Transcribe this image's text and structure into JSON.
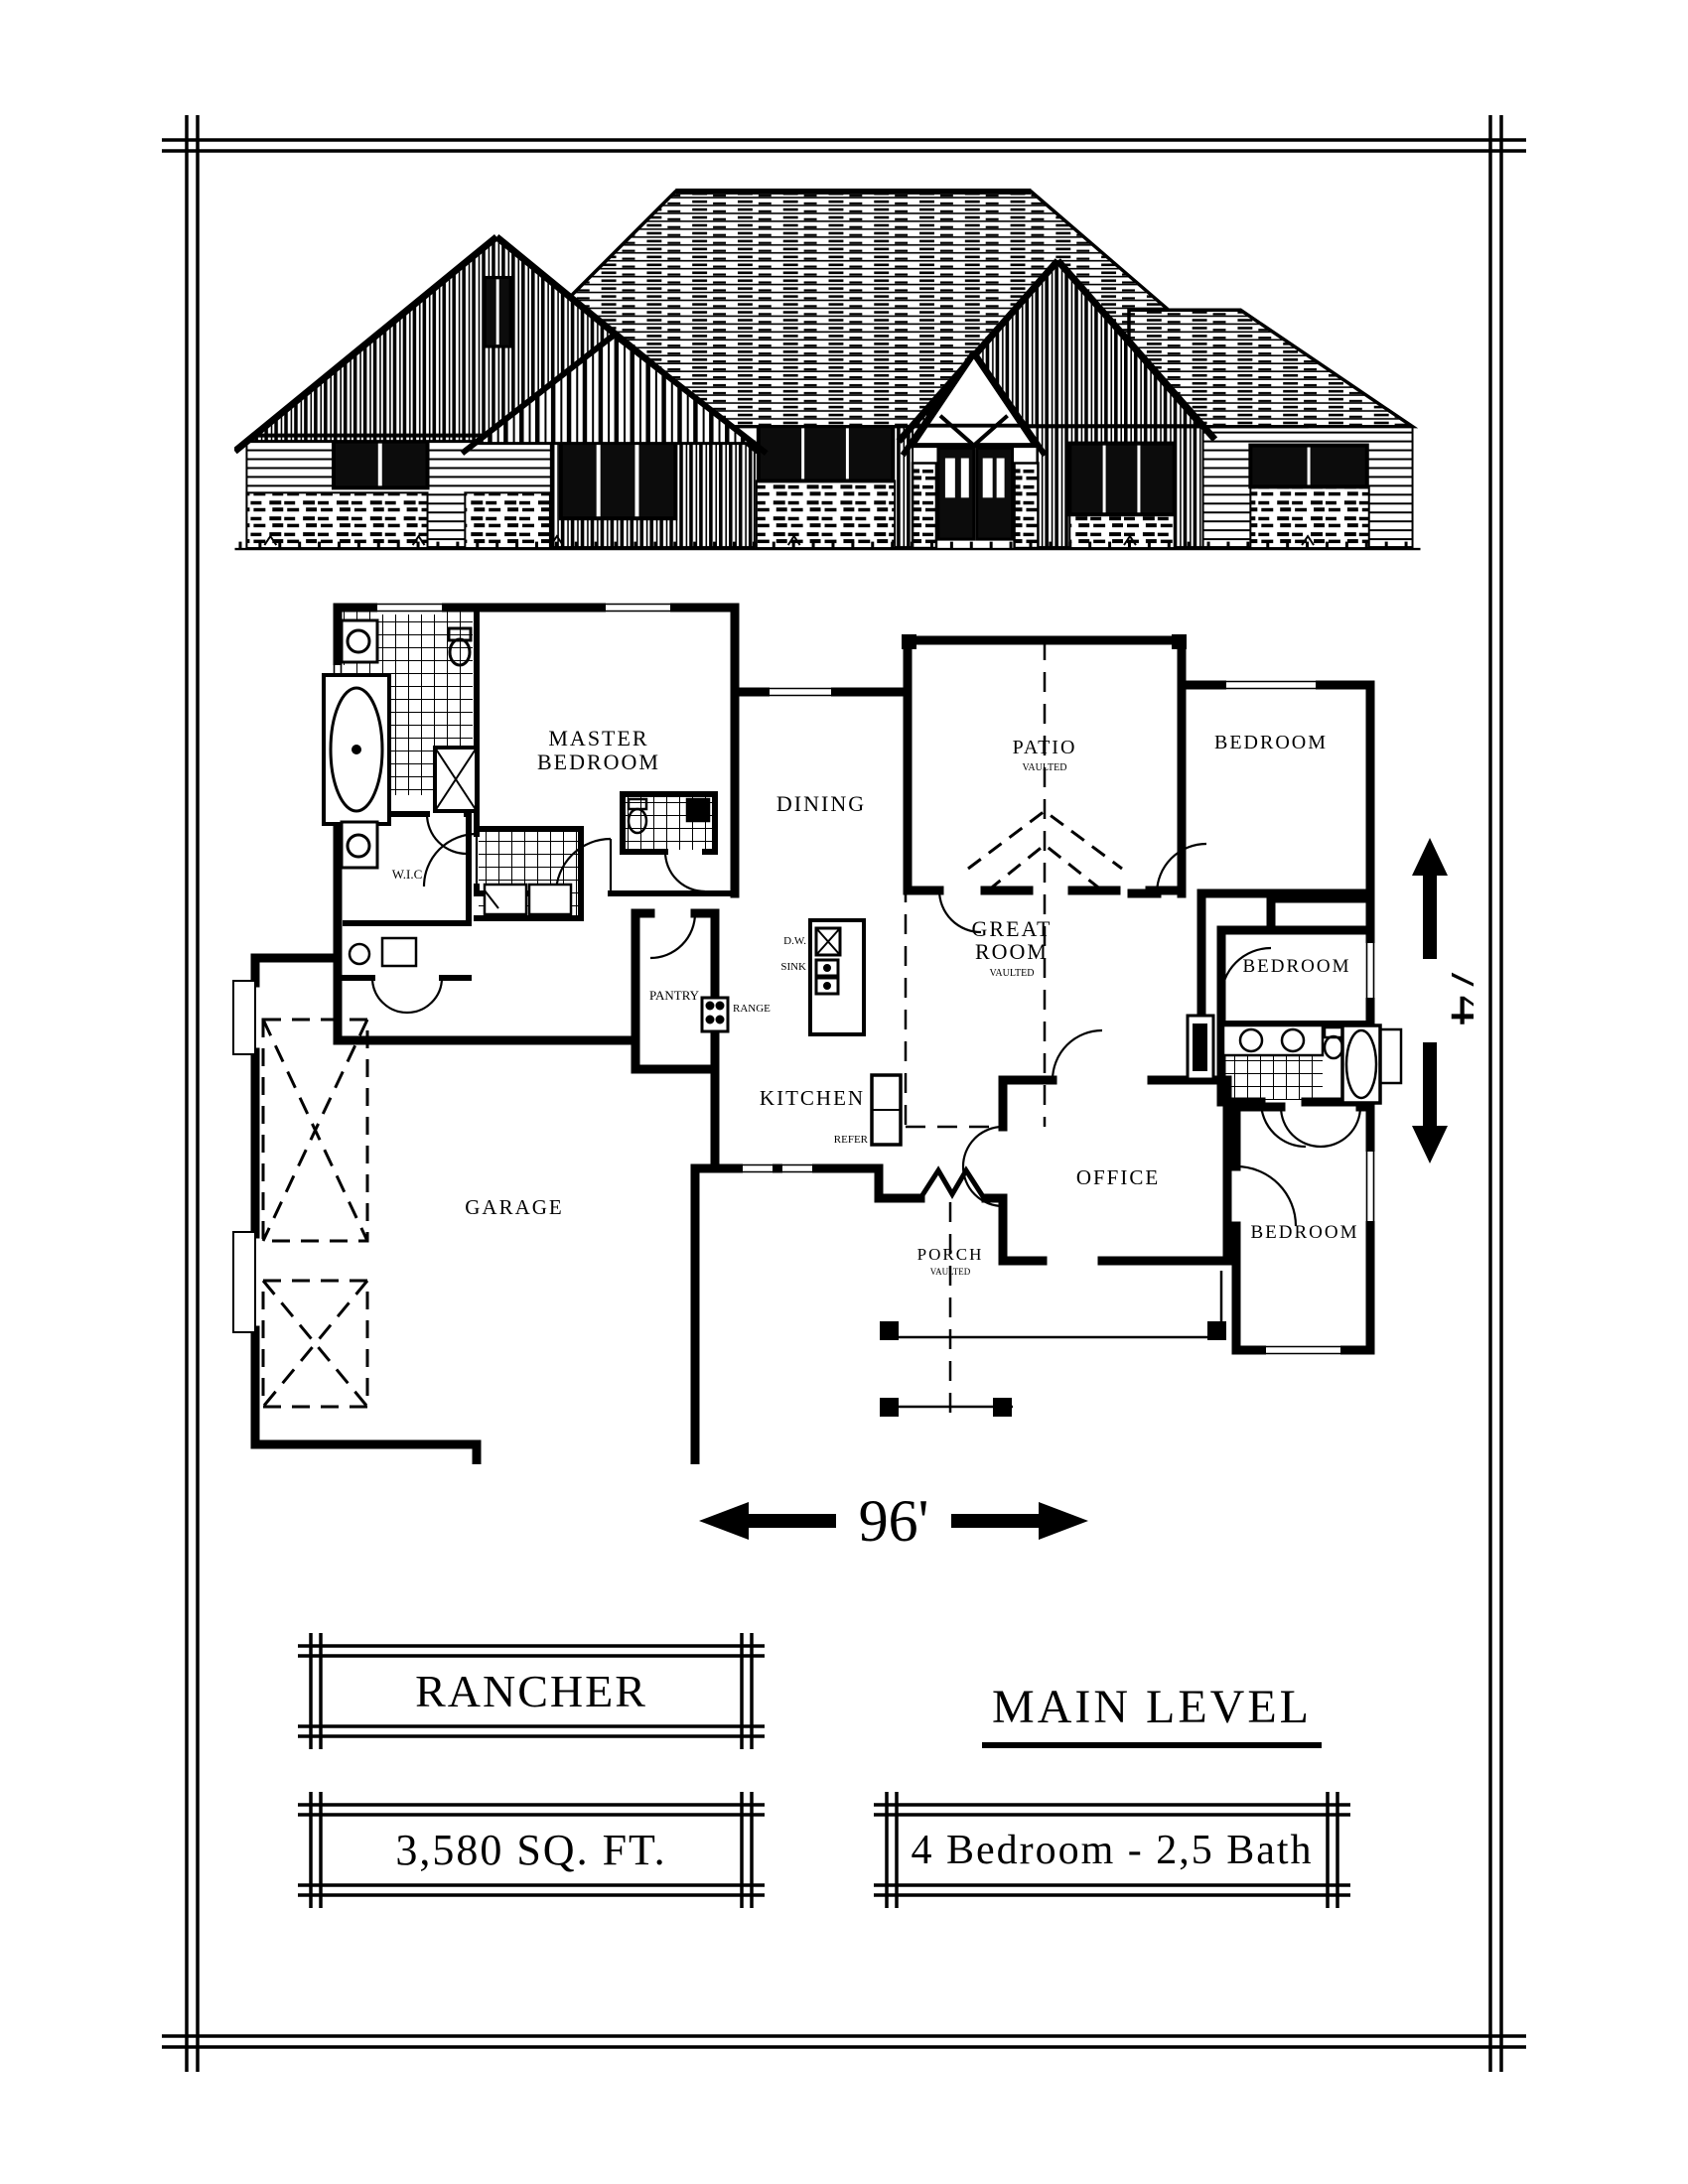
{
  "plan_name": "RANCHER",
  "level": "MAIN LEVEL",
  "area": "3,580 SQ. FT.",
  "configuration": "4 Bedroom - 2,5 Bath",
  "dimensions": {
    "width": "96'",
    "depth": "74'"
  },
  "rooms": {
    "master": [
      "MASTER",
      "BEDROOM"
    ],
    "dining": "DINING",
    "patio": "PATIO",
    "patio_note": "VAULTED",
    "bedroom_top": "BEDROOM",
    "great": [
      "GREAT",
      "ROOM"
    ],
    "great_note": "VAULTED",
    "bedroom_mid": "BEDROOM",
    "bedroom_bottom": "BEDROOM",
    "wic": "W.I.C",
    "pantry": "PANTRY",
    "kitchen": "KITCHEN",
    "office": "OFFICE",
    "garage": "GARAGE",
    "porch": "PORCH",
    "porch_note": "VAULTED"
  },
  "fixtures": {
    "dw": "D.W.",
    "sink": "SINK",
    "range": "RANGE",
    "refer": "REFER"
  },
  "ink": "#000000"
}
